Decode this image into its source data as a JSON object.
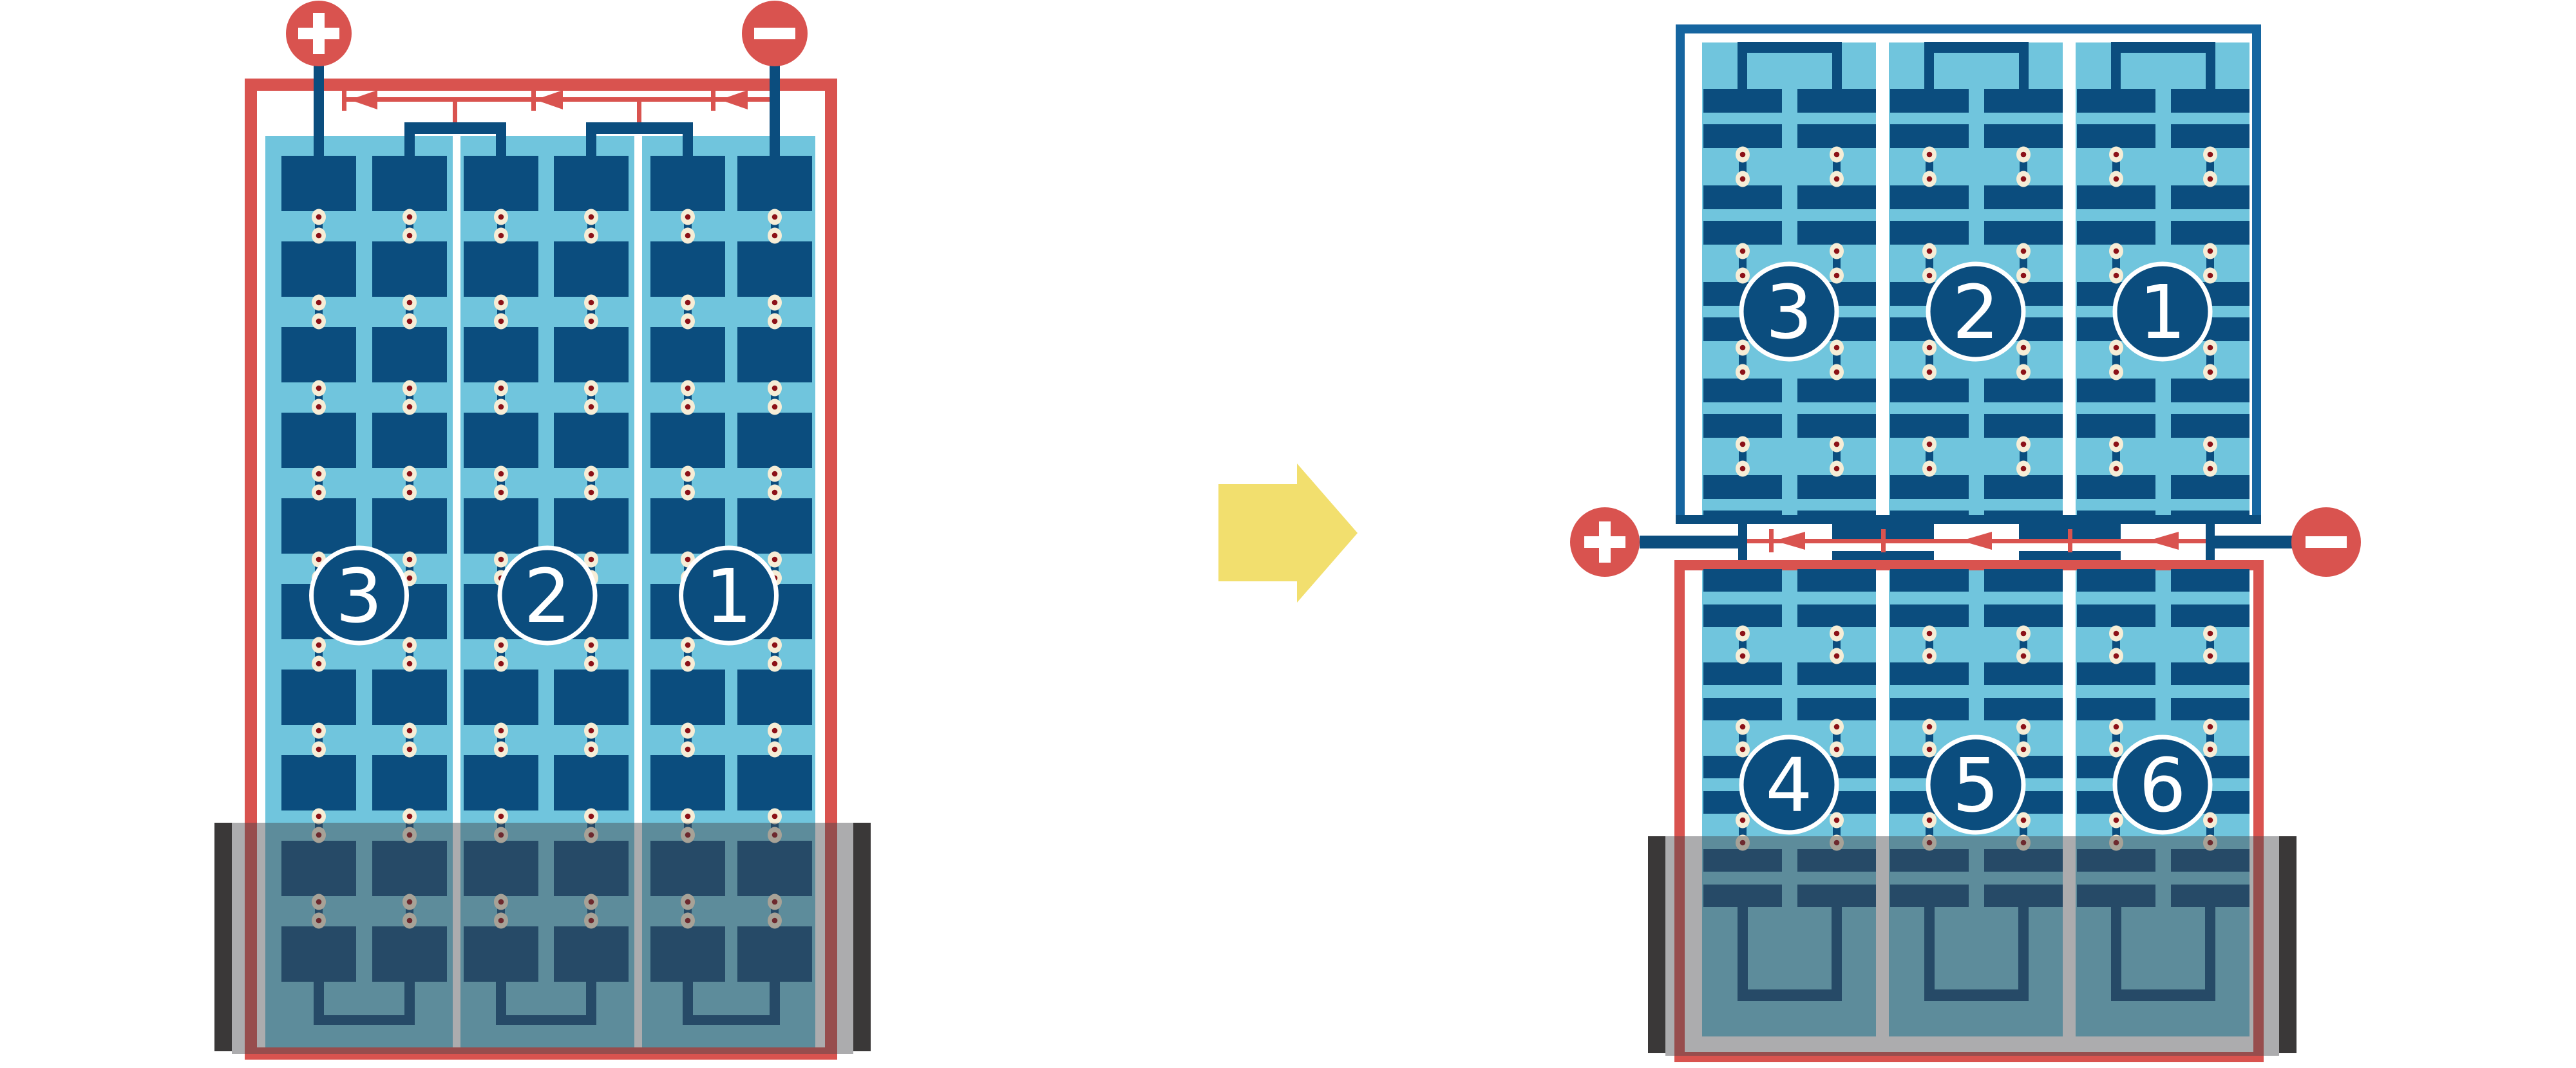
{
  "diagram": {
    "left_battery": {
      "name": "combined-six-cell-battery",
      "cell_labels": [
        "3",
        "2",
        "1"
      ],
      "terminals": {
        "positive": "+",
        "negative": "−"
      }
    },
    "transform_arrow": {
      "icon": "right-arrow-icon"
    },
    "split_battery": {
      "top_cell_labels": [
        "3",
        "2",
        "1"
      ],
      "bottom_cell_labels": [
        "4",
        "5",
        "6"
      ],
      "terminals": {
        "positive": "+",
        "negative": "−"
      }
    },
    "colors": {
      "red": "#d9534f",
      "navy": "#0b4d7e",
      "electrolyte_blue": "#70c5dd",
      "case_border_blue": "#1565a0",
      "rivet_cream": "#f6edd6",
      "rivet_maroon": "#8c1117",
      "arrow_yellow": "#f2df6e",
      "stand_gray": "rgba(72,72,75,0.45)",
      "stand_end_bar": "#3a3838",
      "separator_white": "#ffffff",
      "background": "#ffffff"
    }
  }
}
